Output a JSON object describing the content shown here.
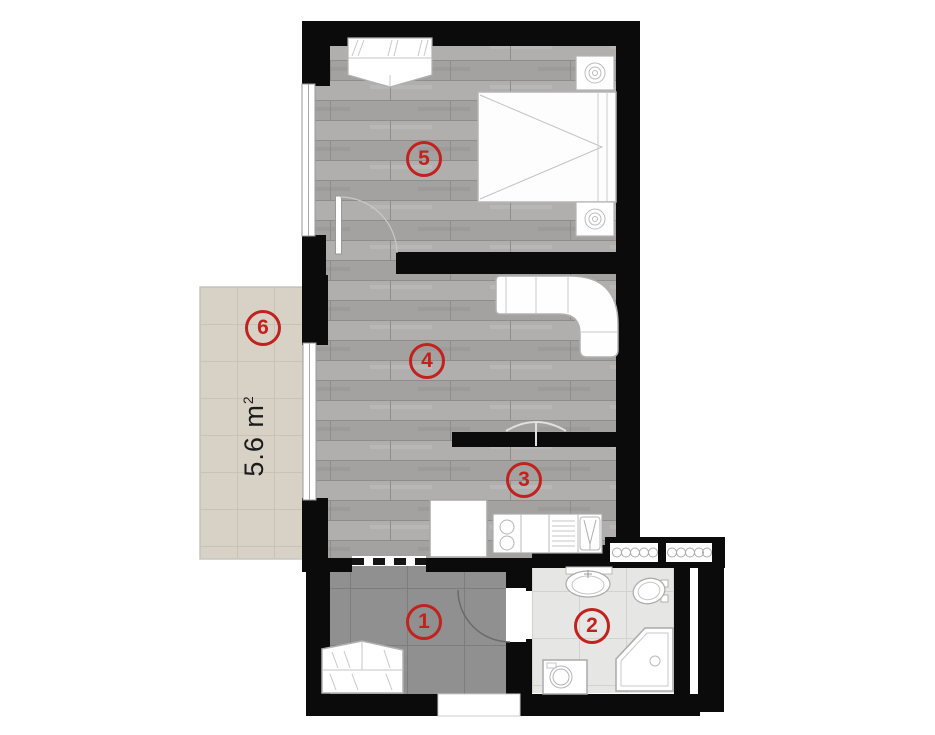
{
  "plan": {
    "name": "apartment-floor-plan",
    "colors": {
      "accent": "#c1221e",
      "wall": "#0b0b0b",
      "wood_floor": "#a8a8a8",
      "hall_tile": "#909090",
      "bath_tile": "#e6e6e4",
      "balcony_tile": "#d8d1c5"
    }
  },
  "rooms": {
    "hall": {
      "label": "1",
      "name": "hallway"
    },
    "bath": {
      "label": "2",
      "name": "bathroom"
    },
    "kitchen": {
      "label": "3",
      "name": "kitchen"
    },
    "living": {
      "label": "4",
      "name": "living-room"
    },
    "bedroom": {
      "label": "5",
      "name": "bedroom"
    },
    "balcony": {
      "label": "6",
      "name": "balcony",
      "area_value": "5.6 m",
      "area_sup": "2"
    }
  }
}
